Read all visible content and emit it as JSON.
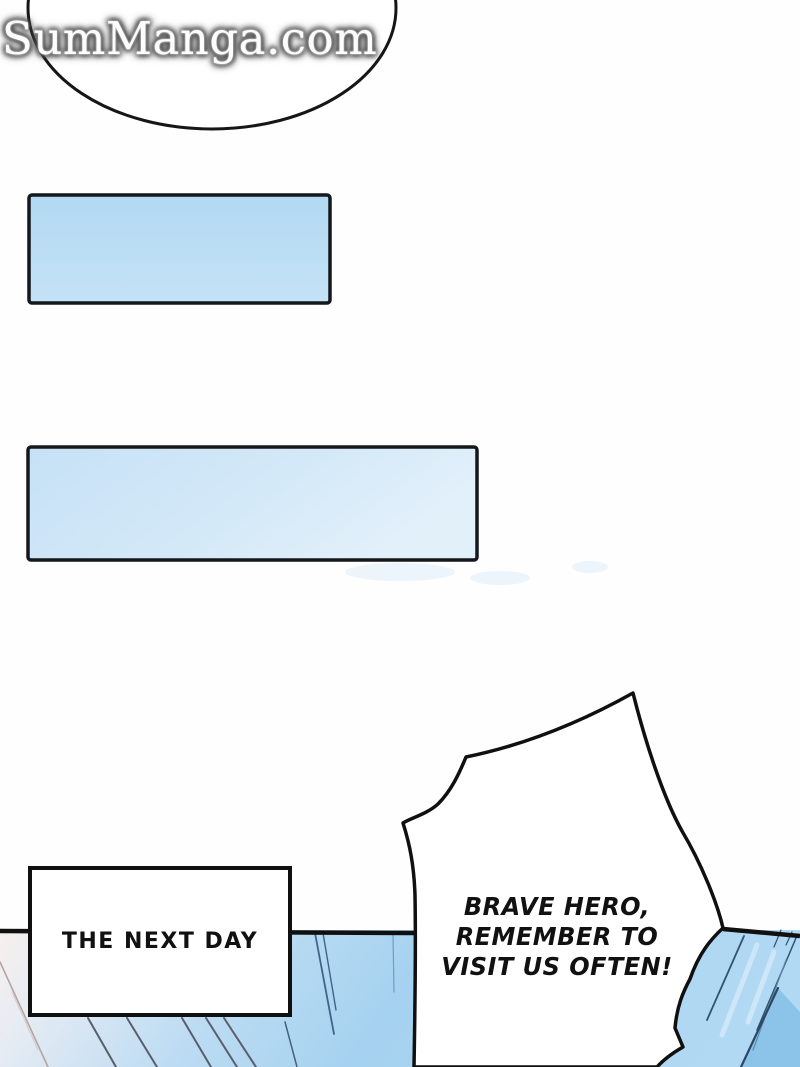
{
  "site": {
    "watermark": "SumManga.com"
  },
  "page": {
    "caption": "THE NEXT DAY",
    "speech_lines": [
      "BRAVE HERO,",
      "REMEMBER TO",
      "VISIT US OFTEN!"
    ]
  },
  "colors": {
    "ink": "#111111",
    "panel_blue": "#a5d2f0",
    "panel_pink": "#f7efee",
    "panel_deep_blue": "#8cc3e9",
    "rect1_fill": "#b7dcf4",
    "rect2_fill": "#cde5f7",
    "watermark_fill": "#fdfdfd",
    "watermark_glow": "#5a5a5a"
  }
}
